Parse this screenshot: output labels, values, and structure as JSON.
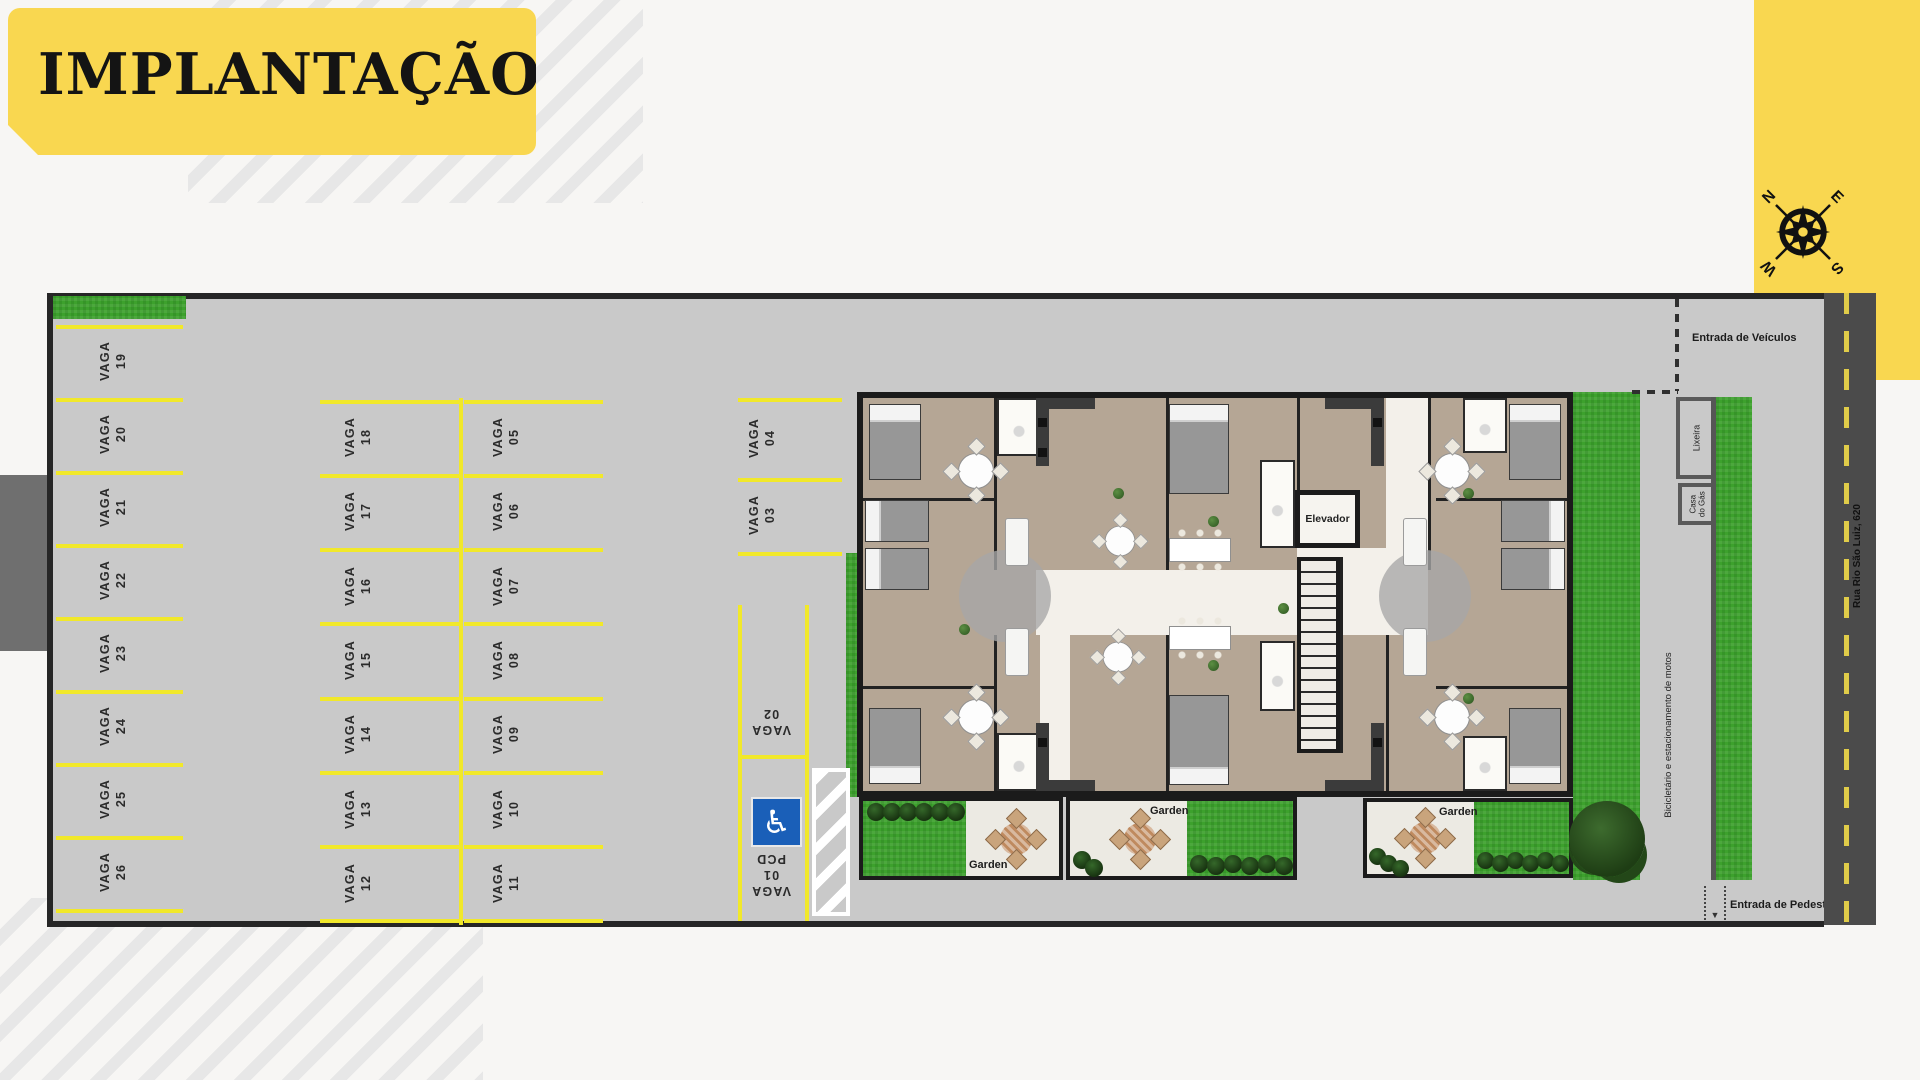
{
  "title": {
    "text": "IMPLANTAÇÃO"
  },
  "compass": {
    "n": "N",
    "e": "E",
    "s": "S",
    "w": "W"
  },
  "parking": {
    "left": [
      [
        "VAGA",
        "19"
      ],
      [
        "VAGA",
        "20"
      ],
      [
        "VAGA",
        "21"
      ],
      [
        "VAGA",
        "22"
      ],
      [
        "VAGA",
        "23"
      ],
      [
        "VAGA",
        "24"
      ],
      [
        "VAGA",
        "25"
      ],
      [
        "VAGA",
        "26"
      ]
    ],
    "mid_left": [
      [
        "VAGA",
        "18"
      ],
      [
        "VAGA",
        "17"
      ],
      [
        "VAGA",
        "16"
      ],
      [
        "VAGA",
        "15"
      ],
      [
        "VAGA",
        "14"
      ],
      [
        "VAGA",
        "13"
      ],
      [
        "VAGA",
        "12"
      ]
    ],
    "mid_right": [
      [
        "VAGA",
        "05"
      ],
      [
        "VAGA",
        "06"
      ],
      [
        "VAGA",
        "07"
      ],
      [
        "VAGA",
        "08"
      ],
      [
        "VAGA",
        "09"
      ],
      [
        "VAGA",
        "10"
      ],
      [
        "VAGA",
        "11"
      ]
    ],
    "top": [
      [
        "VAGA",
        "04"
      ],
      [
        "VAGA",
        "03"
      ]
    ],
    "flipped": [
      [
        "VAGA",
        "02"
      ],
      [
        "VAGA",
        "01",
        "PCD"
      ]
    ],
    "pcd_icon": "♿"
  },
  "building": {
    "elevator": "Elevador",
    "garden_labels": [
      "Garden",
      "Garden",
      "Garden"
    ]
  },
  "site": {
    "entrance_vehicles": "Entrada de Veículos",
    "entrance_pedestrians": "Entrada de Pedestres",
    "trash": "Lixeira",
    "gas_house_lines": [
      "Casa",
      "do Gás"
    ],
    "bike_moto": "Bicicletário e estacionamento de motos",
    "street_name": "Rua Rio São Luiz, 620"
  },
  "colors": {
    "accent_yellow": "#f9d750",
    "parking_line_yellow": "#f1e82a",
    "asphalt_gray": "#c9c9c9",
    "road_gray": "#4b4b4b",
    "grass_green": "#3da12d",
    "handicap_blue": "#1a5fb8"
  }
}
